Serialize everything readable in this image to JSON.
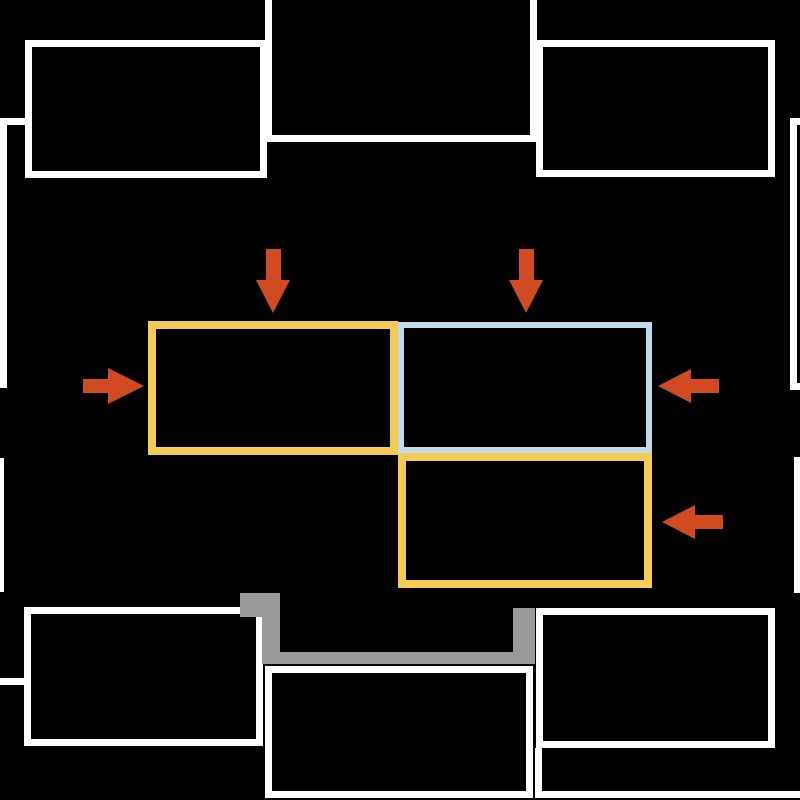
{
  "canvas": {
    "width": 800,
    "height": 800,
    "background": "#000000"
  },
  "colors": {
    "wall": "#ffffff",
    "highlight_yellow": "#f3cb55",
    "highlight_blue": "#c2dbec",
    "arrow": "#d14a21",
    "pipe": "#999999"
  },
  "rooms": [
    {
      "name": "room-top-left",
      "x": 25,
      "y": 40,
      "w": 242,
      "h": 138,
      "bw": 7
    },
    {
      "name": "room-top-center",
      "x": 265,
      "y": -30,
      "w": 272,
      "h": 172,
      "bw": 7
    },
    {
      "name": "room-top-right",
      "x": 536,
      "y": 40,
      "w": 239,
      "h": 137,
      "bw": 7
    },
    {
      "name": "room-right-upper",
      "x": 790,
      "y": 118,
      "w": 60,
      "h": 272,
      "bw": 7
    },
    {
      "name": "room-right-lower",
      "x": 794,
      "y": 457,
      "w": 56,
      "h": 136,
      "bw": 6
    },
    {
      "name": "room-left-upper",
      "x": -40,
      "y": 118,
      "w": 47,
      "h": 270,
      "bw": 7
    },
    {
      "name": "room-left-lower",
      "x": -40,
      "y": 458,
      "w": 44,
      "h": 134,
      "bw": 7
    },
    {
      "name": "room-bottom-left",
      "x": 24,
      "y": 607,
      "w": 239,
      "h": 139,
      "bw": 7
    },
    {
      "name": "room-bottom-center",
      "x": 265,
      "y": 666,
      "w": 268,
      "h": 132,
      "bw": 7
    },
    {
      "name": "room-bottom-right",
      "x": 536,
      "y": 608,
      "w": 239,
      "h": 140,
      "bw": 7
    }
  ],
  "walls": [
    {
      "name": "wall-connector-top-left",
      "x": 5,
      "y": 118,
      "w": 20,
      "h": 7
    },
    {
      "name": "wall-stub-bottom-left",
      "x": -10,
      "y": 678,
      "w": 34,
      "h": 7
    },
    {
      "name": "wall-bottom-right-vertical",
      "x": 535,
      "y": 748,
      "w": 7,
      "h": 50
    },
    {
      "name": "wall-bottom-right-horizontal",
      "x": 535,
      "y": 791,
      "w": 275,
      "h": 7
    }
  ],
  "highlights": [
    {
      "name": "highlight-yellow-top-left",
      "x": 148,
      "y": 321,
      "w": 250,
      "h": 134,
      "bw": 8,
      "color_key": "highlight_yellow"
    },
    {
      "name": "highlight-blue-top-right",
      "x": 398,
      "y": 322,
      "w": 254,
      "h": 131,
      "bw": 6,
      "color_key": "highlight_blue"
    },
    {
      "name": "highlight-yellow-bottom-right",
      "x": 398,
      "y": 453,
      "w": 254,
      "h": 135,
      "bw": 8,
      "color_key": "highlight_yellow"
    }
  ],
  "pipe_segments": [
    {
      "name": "pipe-block",
      "x": 240,
      "y": 593,
      "w": 40,
      "h": 24
    },
    {
      "name": "pipe-left-vertical",
      "x": 262,
      "y": 615,
      "w": 18,
      "h": 49
    },
    {
      "name": "pipe-horizontal",
      "x": 264,
      "y": 652,
      "w": 271,
      "h": 12
    },
    {
      "name": "pipe-right-vertical",
      "x": 513,
      "y": 608,
      "w": 22,
      "h": 56
    }
  ],
  "arrows": [
    {
      "name": "arrow-down-into-yellow-top",
      "dir": "down",
      "tip_x": 273,
      "tip_y": 313,
      "length": 64,
      "shaft_w": 15,
      "head_w": 35,
      "head_len": 33
    },
    {
      "name": "arrow-down-into-blue",
      "dir": "down",
      "tip_x": 526,
      "tip_y": 313,
      "length": 64,
      "shaft_w": 15,
      "head_w": 35,
      "head_len": 33
    },
    {
      "name": "arrow-right-into-yellow-top",
      "dir": "right",
      "tip_x": 144,
      "tip_y": 386,
      "length": 61,
      "shaft_w": 14,
      "head_w": 36,
      "head_len": 36
    },
    {
      "name": "arrow-left-into-blue",
      "dir": "left",
      "tip_x": 658,
      "tip_y": 386,
      "length": 61,
      "shaft_w": 14,
      "head_w": 34,
      "head_len": 33
    },
    {
      "name": "arrow-left-into-yellow-bottom",
      "dir": "left",
      "tip_x": 662,
      "tip_y": 522,
      "length": 61,
      "shaft_w": 14,
      "head_w": 34,
      "head_len": 33
    }
  ]
}
